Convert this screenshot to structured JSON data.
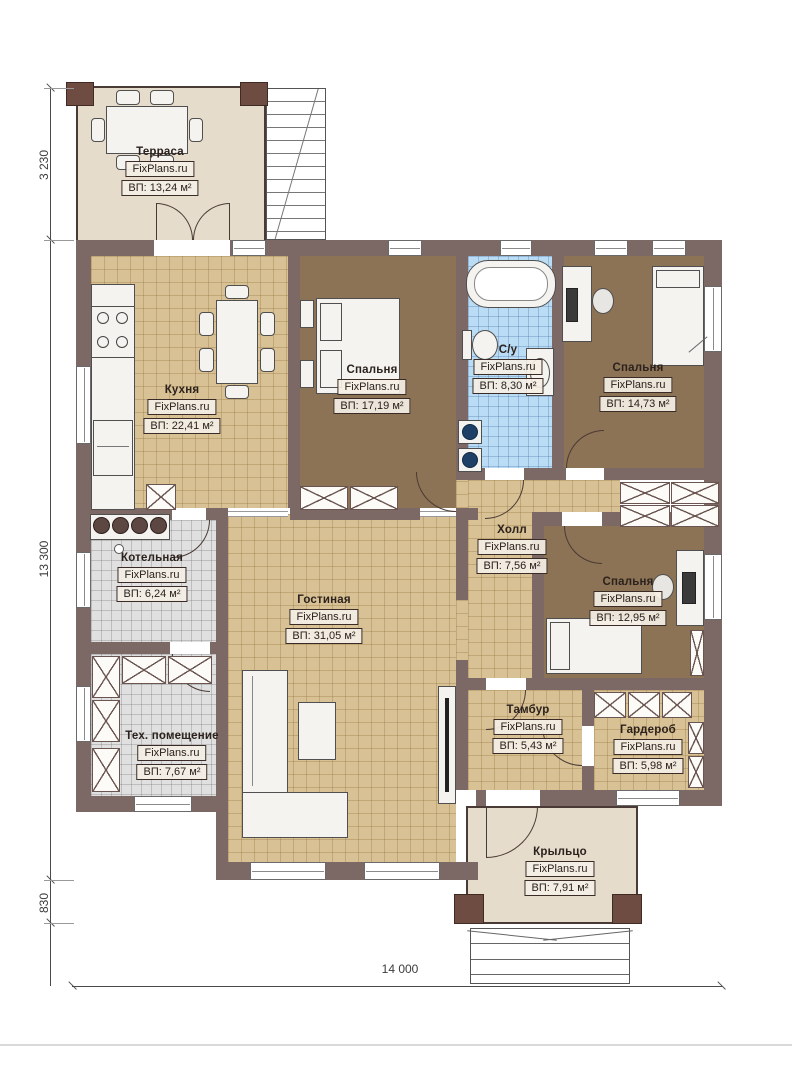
{
  "plan": {
    "watermark": "FixPlans.ru",
    "rooms": [
      {
        "name": "Терраса",
        "brand": "FixPlans.ru",
        "area": "ВП: 13,24 м²"
      },
      {
        "name": "Кухня",
        "brand": "FixPlans.ru",
        "area": "ВП: 22,41 м²"
      },
      {
        "name": "Спальня",
        "brand": "FixPlans.ru",
        "area": "ВП: 17,19 м²"
      },
      {
        "name": "С/у",
        "brand": "FixPlans.ru",
        "area": "ВП: 8,30 м²"
      },
      {
        "name": "Спальня",
        "brand": "FixPlans.ru",
        "area": "ВП: 14,73 м²"
      },
      {
        "name": "Котельная",
        "brand": "FixPlans.ru",
        "area": "ВП: 6,24 м²"
      },
      {
        "name": "Холл",
        "brand": "FixPlans.ru",
        "area": "ВП: 7,56 м²"
      },
      {
        "name": "Спальня",
        "brand": "FixPlans.ru",
        "area": "ВП: 12,95 м²"
      },
      {
        "name": "Гостиная",
        "brand": "FixPlans.ru",
        "area": "ВП: 31,05 м²"
      },
      {
        "name": "Тех. помещение",
        "brand": "FixPlans.ru",
        "area": "ВП: 7,67 м²"
      },
      {
        "name": "Тамбур",
        "brand": "FixPlans.ru",
        "area": "ВП: 5,43 м²"
      },
      {
        "name": "Гардероб",
        "brand": "FixPlans.ru",
        "area": "ВП: 5,98 м²"
      },
      {
        "name": "Крыльцо",
        "brand": "FixPlans.ru",
        "area": "ВП: 7,91 м²"
      }
    ],
    "dimensions": {
      "terrace_depth": "3 230",
      "house_depth": "13 300",
      "porch_drop": "830",
      "house_width": "14 000"
    },
    "colors": {
      "wall": "#7c6965",
      "tile_tan": "#d8c194",
      "floor_brown": "#8d7355",
      "tile_blue": "#badcf4",
      "tile_gray": "#e0e0e0",
      "floor_beige": "#e6dccb"
    }
  }
}
